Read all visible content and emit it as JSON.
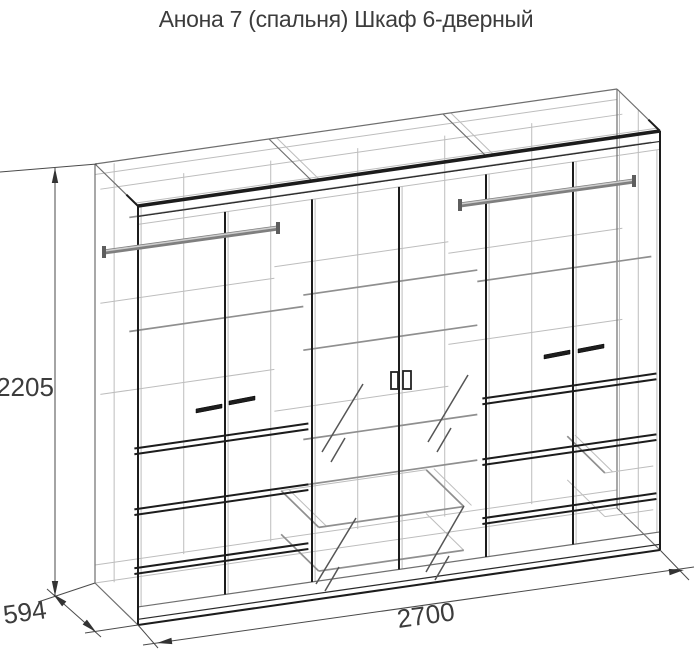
{
  "title": "Анона 7 (спальня) Шкаф 6-дверный",
  "diagram": {
    "object": "Шкаф 6-дверный",
    "collection": "Анона 7 (спальня)",
    "dimensions": {
      "height": "2205",
      "depth": "594",
      "width": "2700"
    },
    "colors": {
      "background": "#ffffff",
      "line_dark": "#1c1c1c",
      "line_gray": "#8f8f8f",
      "text": "#3c3c3c"
    }
  }
}
